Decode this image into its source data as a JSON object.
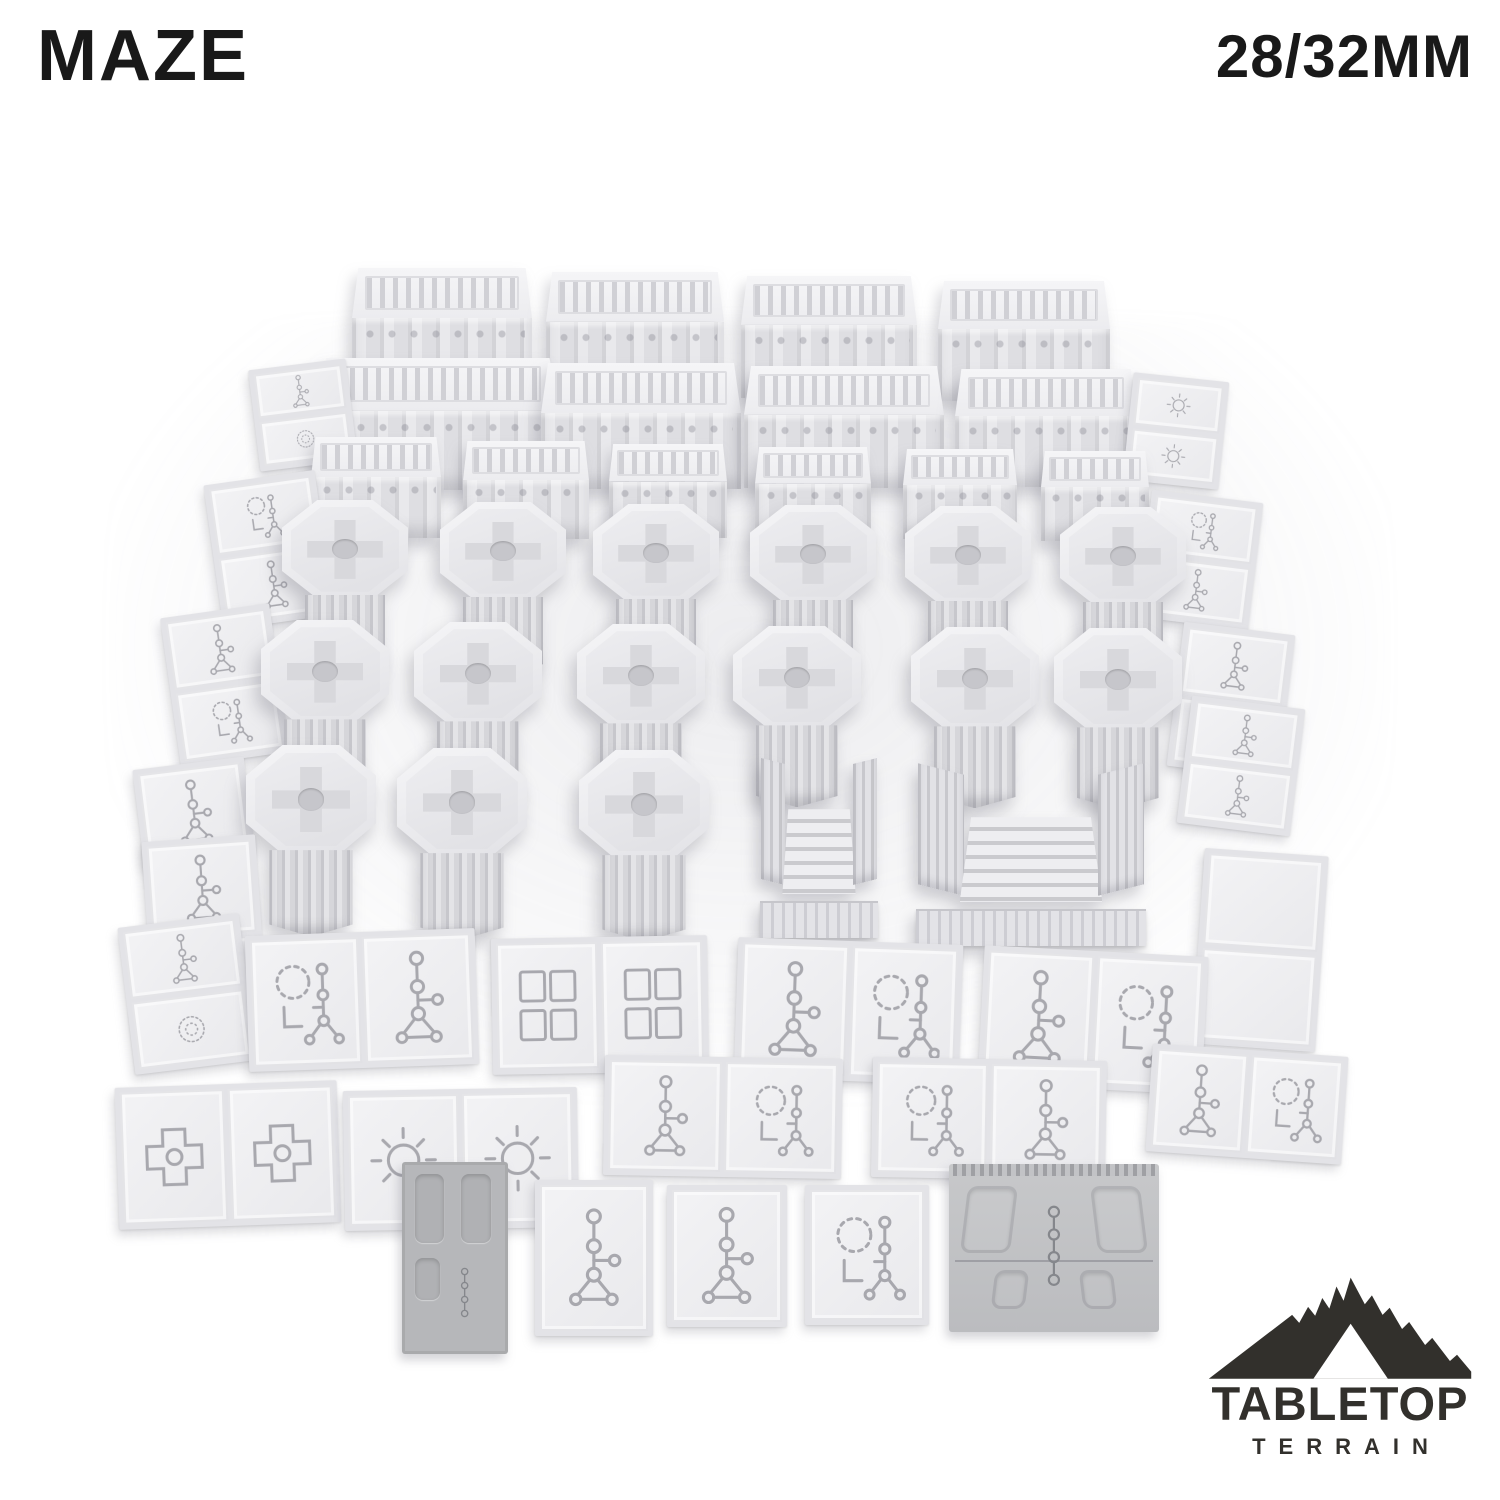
{
  "header": {
    "title": "MAZE",
    "scale_label": "28/32MM"
  },
  "logo": {
    "brand_top": "TABLETOP",
    "brand_bottom": "TERRAIN",
    "color": "#32302c"
  },
  "colors": {
    "background": "#ffffff",
    "text": "#191919",
    "logo": "#32302c",
    "piece_light": "#f2f2f4",
    "piece_mid": "#e0e0e4",
    "piece_dark": "#b6b7ba",
    "glyph": "#a8a8ae"
  },
  "scene": {
    "alt": "Gray 3D-printed modular maze terrain set on a white background: large greebled wall blocks in back rows, ornate octagonal-capped pillars in a grid, two stair gate pieces, and many etched square floor tiles cascading down the sides and across the front.",
    "inventory": {
      "wall_blocks": 14,
      "pillars": 15,
      "stair_gates": 2,
      "floor_tile_groups": 23,
      "printed_dark_tiles": 2
    },
    "pieces": [
      {
        "t": "wall",
        "x": 352,
        "y": 268,
        "w": 180,
        "h": 126
      },
      {
        "t": "wall",
        "x": 546,
        "y": 272,
        "w": 178,
        "h": 124
      },
      {
        "t": "wall",
        "x": 741,
        "y": 276,
        "w": 176,
        "h": 122
      },
      {
        "t": "wall",
        "x": 938,
        "y": 281,
        "w": 172,
        "h": 120
      },
      {
        "t": "wall",
        "x": 318,
        "y": 358,
        "w": 240,
        "h": 132
      },
      {
        "t": "wall",
        "x": 541,
        "y": 363,
        "w": 200,
        "h": 126
      },
      {
        "t": "wall",
        "x": 744,
        "y": 366,
        "w": 200,
        "h": 122
      },
      {
        "t": "wall",
        "x": 955,
        "y": 369,
        "w": 182,
        "h": 118
      },
      {
        "t": "tiles",
        "x": 254,
        "y": 364,
        "w": 98,
        "h": 102,
        "rot": -7,
        "dir": "col",
        "cells": [
          "rune",
          "wreath"
        ]
      },
      {
        "t": "tiles",
        "x": 1128,
        "y": 377,
        "w": 96,
        "h": 108,
        "rot": 6,
        "dir": "col",
        "cells": [
          "sun",
          "sun"
        ]
      },
      {
        "t": "wall",
        "x": 311,
        "y": 437,
        "w": 130,
        "h": 101
      },
      {
        "t": "wall",
        "x": 463,
        "y": 441,
        "w": 126,
        "h": 98
      },
      {
        "t": "wall",
        "x": 609,
        "y": 444,
        "w": 118,
        "h": 94
      },
      {
        "t": "wall",
        "x": 755,
        "y": 447,
        "w": 116,
        "h": 92
      },
      {
        "t": "wall",
        "x": 903,
        "y": 449,
        "w": 114,
        "h": 90
      },
      {
        "t": "wall",
        "x": 1041,
        "y": 451,
        "w": 108,
        "h": 90
      },
      {
        "t": "tiles",
        "x": 213,
        "y": 477,
        "w": 112,
        "h": 146,
        "rot": -8,
        "dir": "col",
        "cells": [
          "wreath-rune",
          "rune"
        ]
      },
      {
        "t": "tiles",
        "x": 1144,
        "y": 496,
        "w": 112,
        "h": 128,
        "rot": 7,
        "dir": "col",
        "cells": [
          "wreath-rune",
          "rune"
        ]
      },
      {
        "t": "pillar",
        "x": 282,
        "y": 500,
        "w": 126,
        "h": 170
      },
      {
        "t": "pillar",
        "x": 440,
        "y": 502,
        "w": 126,
        "h": 170
      },
      {
        "t": "pillar",
        "x": 593,
        "y": 504,
        "w": 126,
        "h": 170
      },
      {
        "t": "pillar",
        "x": 750,
        "y": 505,
        "w": 126,
        "h": 170
      },
      {
        "t": "pillar",
        "x": 905,
        "y": 506,
        "w": 126,
        "h": 170
      },
      {
        "t": "pillar",
        "x": 1060,
        "y": 507,
        "w": 126,
        "h": 170
      },
      {
        "t": "tiles",
        "x": 170,
        "y": 610,
        "w": 110,
        "h": 150,
        "rot": -8,
        "dir": "col",
        "cells": [
          "rune",
          "wreath-rune"
        ]
      },
      {
        "t": "tiles",
        "x": 1175,
        "y": 628,
        "w": 112,
        "h": 145,
        "rot": 7,
        "dir": "col",
        "cells": [
          "rune",
          "wreath-rune"
        ]
      },
      {
        "t": "pillar",
        "x": 261,
        "y": 620,
        "w": 128,
        "h": 178
      },
      {
        "t": "pillar",
        "x": 414,
        "y": 622,
        "w": 128,
        "h": 178
      },
      {
        "t": "pillar",
        "x": 577,
        "y": 624,
        "w": 128,
        "h": 178
      },
      {
        "t": "pillar",
        "x": 733,
        "y": 626,
        "w": 128,
        "h": 178
      },
      {
        "t": "pillar",
        "x": 911,
        "y": 627,
        "w": 128,
        "h": 178
      },
      {
        "t": "pillar",
        "x": 1054,
        "y": 628,
        "w": 128,
        "h": 178
      },
      {
        "t": "tiles",
        "x": 138,
        "y": 763,
        "w": 112,
        "h": 98,
        "rot": -7,
        "dir": "col",
        "cells": [
          "rune"
        ]
      },
      {
        "t": "tiles",
        "x": 1184,
        "y": 702,
        "w": 114,
        "h": 128,
        "rot": 7,
        "dir": "col",
        "cells": [
          "rune",
          "rune"
        ]
      },
      {
        "t": "tiles",
        "x": 1198,
        "y": 852,
        "w": 124,
        "h": 196,
        "rot": 4,
        "dir": "col",
        "cells": [
          "plain",
          "plain"
        ]
      },
      {
        "t": "pillar",
        "x": 246,
        "y": 745,
        "w": 130,
        "h": 188
      },
      {
        "t": "pillar",
        "x": 397,
        "y": 748,
        "w": 130,
        "h": 188
      },
      {
        "t": "pillar",
        "x": 579,
        "y": 750,
        "w": 130,
        "h": 188
      },
      {
        "t": "stair",
        "x": 760,
        "y": 754,
        "w": 118,
        "h": 184
      },
      {
        "t": "stair",
        "x": 916,
        "y": 762,
        "w": 230,
        "h": 184
      },
      {
        "t": "tiles",
        "x": 148,
        "y": 838,
        "w": 114,
        "h": 198,
        "rot": -4,
        "dir": "col",
        "cells": [
          "rune",
          "rune"
        ]
      },
      {
        "t": "tiles",
        "x": 126,
        "y": 920,
        "w": 122,
        "h": 148,
        "rot": -7,
        "dir": "col",
        "cells": [
          "rune",
          "wreath"
        ]
      },
      {
        "t": "tiles",
        "x": 247,
        "y": 932,
        "w": 230,
        "h": 136,
        "rot": -2,
        "dir": "row",
        "cells": [
          "wreath-rune",
          "rune"
        ]
      },
      {
        "t": "tiles",
        "x": 492,
        "y": 937,
        "w": 216,
        "h": 136,
        "rot": -1,
        "dir": "row",
        "cells": [
          "panels",
          "panels"
        ]
      },
      {
        "t": "tiles",
        "x": 736,
        "y": 941,
        "w": 225,
        "h": 140,
        "rot": 2,
        "dir": "row",
        "cells": [
          "rune",
          "wreath-rune"
        ]
      },
      {
        "t": "tiles",
        "x": 981,
        "y": 951,
        "w": 224,
        "h": 138,
        "rot": 3,
        "dir": "row",
        "cells": [
          "rune",
          "wreath-rune"
        ]
      },
      {
        "t": "tiles",
        "x": 117,
        "y": 1084,
        "w": 222,
        "h": 142,
        "rot": -2,
        "dir": "row",
        "cells": [
          "cross",
          "cross"
        ]
      },
      {
        "t": "tiles",
        "x": 344,
        "y": 1089,
        "w": 234,
        "h": 140,
        "rot": -1,
        "dir": "row",
        "cells": [
          "sun",
          "sun"
        ]
      },
      {
        "t": "tiles",
        "x": 604,
        "y": 1057,
        "w": 238,
        "h": 120,
        "rot": 1,
        "dir": "row",
        "cells": [
          "rune",
          "wreath-rune"
        ]
      },
      {
        "t": "tiles",
        "x": 872,
        "y": 1059,
        "w": 234,
        "h": 120,
        "rot": 1,
        "dir": "row",
        "cells": [
          "wreath-rune",
          "rune"
        ]
      },
      {
        "t": "tiles",
        "x": 1149,
        "y": 1050,
        "w": 196,
        "h": 108,
        "rot": 4,
        "dir": "row",
        "cells": [
          "rune",
          "wreath-rune"
        ]
      },
      {
        "t": "darkprint",
        "x": 402,
        "y": 1162,
        "w": 106,
        "h": 192
      },
      {
        "t": "tiles",
        "x": 535,
        "y": 1180,
        "w": 118,
        "h": 156,
        "dir": "row",
        "cells": [
          "rune"
        ]
      },
      {
        "t": "tiles",
        "x": 667,
        "y": 1185,
        "w": 120,
        "h": 142,
        "dir": "row",
        "cells": [
          "rune"
        ]
      },
      {
        "t": "tiles",
        "x": 805,
        "y": 1185,
        "w": 124,
        "h": 140,
        "dir": "row",
        "cells": [
          "wreath-rune"
        ]
      },
      {
        "t": "darkramp",
        "x": 949,
        "y": 1164,
        "w": 210,
        "h": 168
      }
    ]
  }
}
